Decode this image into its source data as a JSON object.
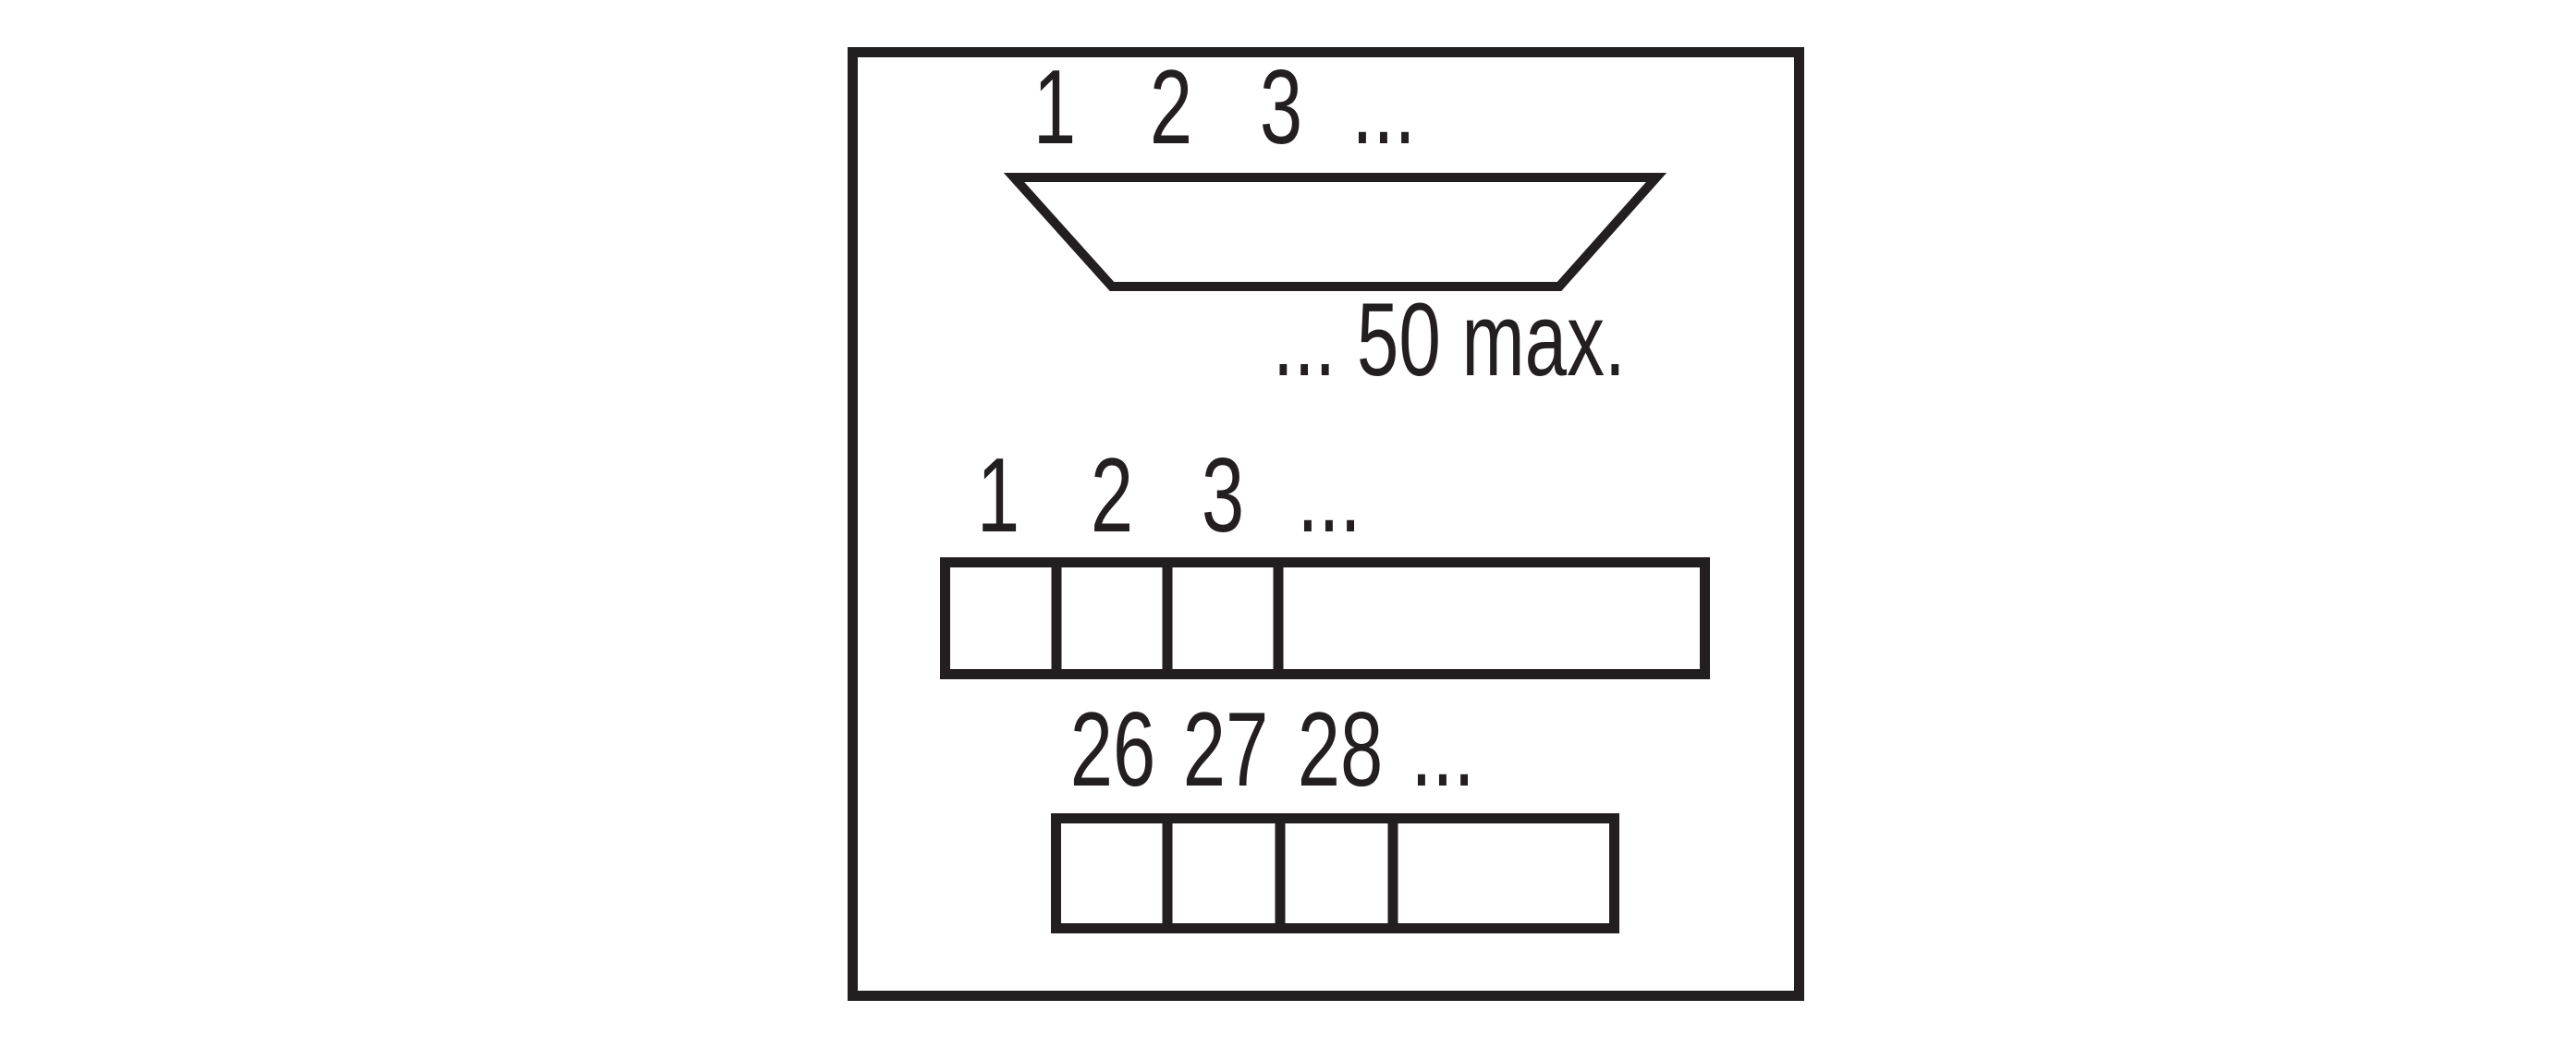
{
  "colors": {
    "ink": "#231f20",
    "background": "#ffffff"
  },
  "connector": {
    "pin_labels": [
      "1",
      "2",
      "3",
      "..."
    ],
    "note": "... 50 max."
  },
  "strip_upper": {
    "pin_labels": [
      "1",
      "2",
      "3",
      "..."
    ]
  },
  "strip_lower": {
    "pin_labels": [
      "26",
      "27",
      "28",
      "..."
    ]
  }
}
